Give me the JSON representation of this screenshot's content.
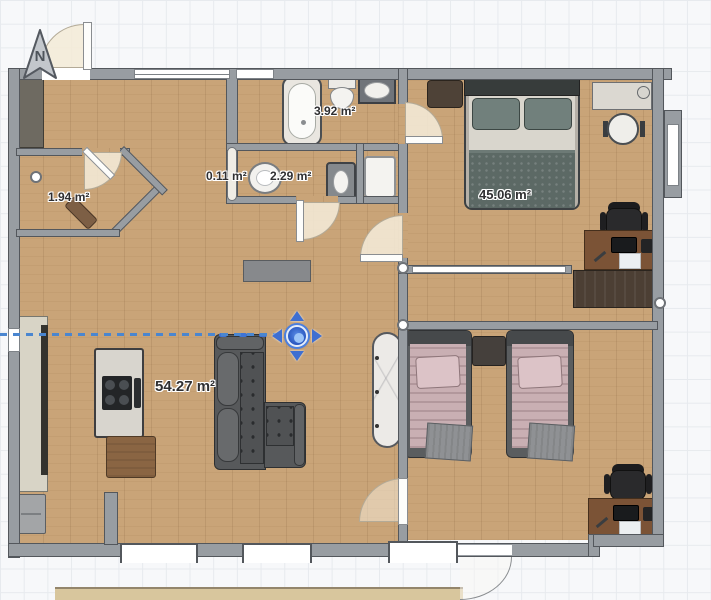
{
  "compass": {
    "label": "N"
  },
  "area_labels": {
    "wc": "1.94 m²",
    "shaft": "0.11 m²",
    "bathroom_small": "2.29 m²",
    "bathroom_main": "3.92 m²",
    "bedroom_master": "45.06 m²",
    "living_room": "54.27 m²"
  },
  "selection": {
    "tool": "move-gizmo",
    "guide_color": "#4a86d0"
  },
  "colors": {
    "wall": "#989da2",
    "floor_wood": "#c9a478",
    "grid_line": "#e7eaee",
    "canvas_bg": "#f7f8fa",
    "accent_blue": "#3f6fd1"
  }
}
